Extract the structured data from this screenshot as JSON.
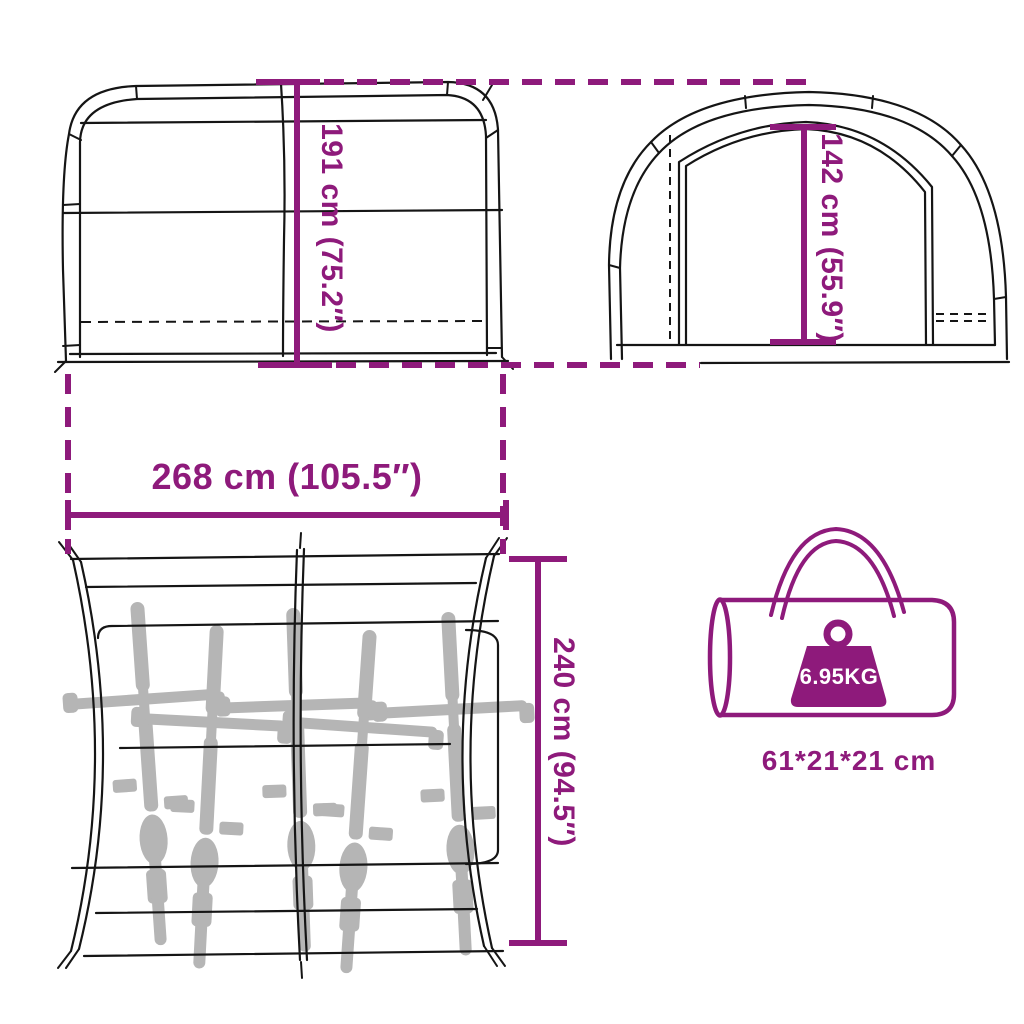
{
  "colors": {
    "accent": "#8E1A7B",
    "line": "#151515",
    "bike_silhouette": "#B5B5B5",
    "background": "#FFFFFF"
  },
  "dimensions": {
    "outer_height": "191 cm (75.2″)",
    "door_height": "142 cm (55.9″)",
    "width": "268 cm (105.5″)",
    "depth": "240 cm (94.5″)"
  },
  "bag": {
    "weight": "6.95KG",
    "packed_size": "61*21*21 cm"
  }
}
